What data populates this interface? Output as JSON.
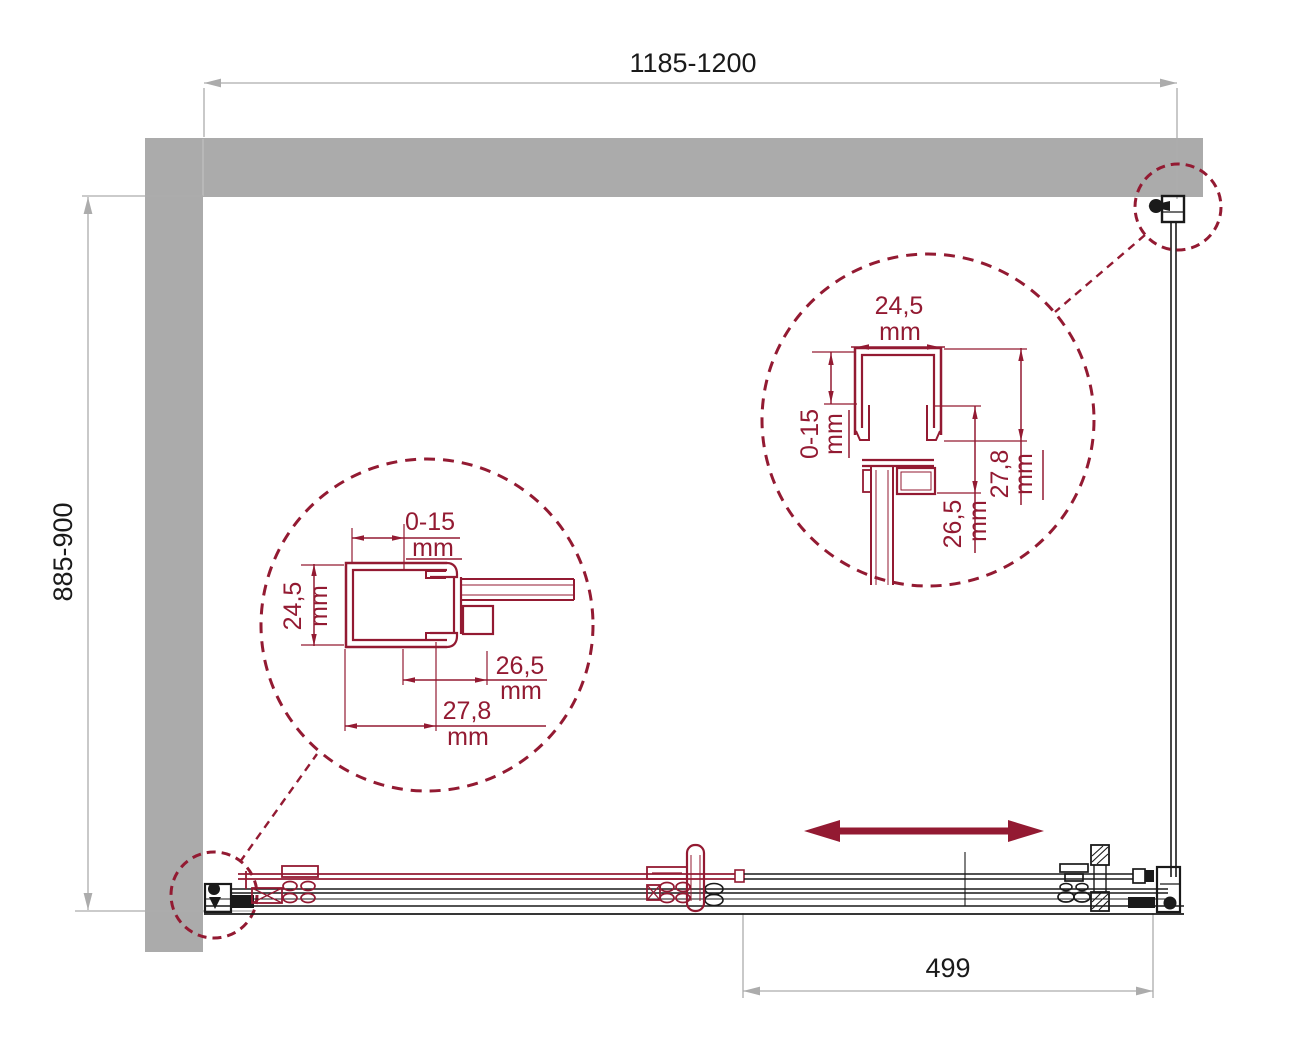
{
  "drawing": {
    "type": "shower-enclosure-plan-drawing",
    "overall": {
      "width": "1185-1200",
      "depth": "885-900",
      "door_travel": "499"
    },
    "detail_left_profile": {
      "adjust": {
        "value": "0-15",
        "unit": "mm"
      },
      "height": {
        "value": "24,5",
        "unit": "mm"
      },
      "overlap_inner": {
        "value": "26,5",
        "unit": "mm"
      },
      "overlap_outer": {
        "value": "27,8",
        "unit": "mm"
      }
    },
    "detail_right_profile": {
      "width": {
        "value": "24,5",
        "unit": "mm"
      },
      "adjust": {
        "value": "0-15",
        "unit": "mm"
      },
      "overlap_inner": {
        "value": "26,5",
        "unit": "mm"
      },
      "overlap_outer": {
        "value": "27,8",
        "unit": "mm"
      }
    },
    "colors": {
      "wall": "#ABABAB",
      "outline": "#1A1A1A",
      "accent": "#931A32",
      "dim_line": "#ACACAC"
    }
  }
}
